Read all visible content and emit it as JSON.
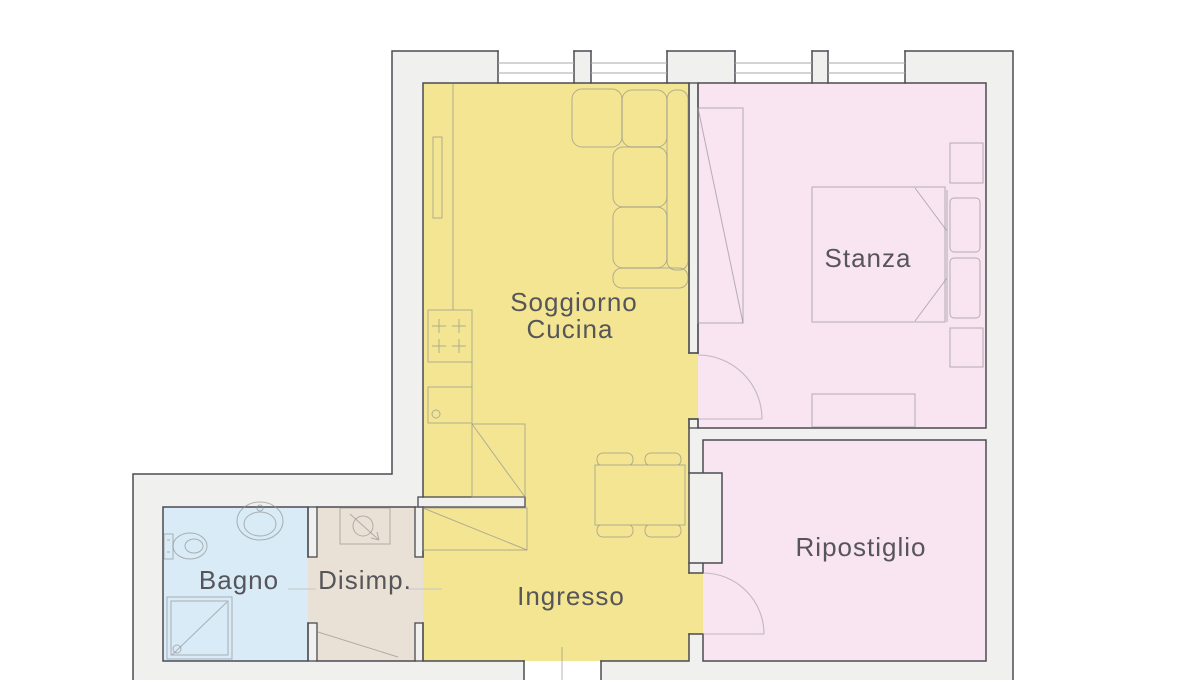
{
  "plan": {
    "title": "Apartment floor plan",
    "rooms": {
      "soggiorno_cucina": {
        "label_line1": "Soggiorno",
        "label_line2": "Cucina",
        "color": "#f3e592"
      },
      "stanza": {
        "label": "Stanza",
        "color": "#f9e4f2"
      },
      "ripostiglio": {
        "label": "Ripostiglio",
        "color": "#f9e4f2"
      },
      "bagno": {
        "label": "Bagno",
        "color": "#d8ebf7"
      },
      "disimpegno": {
        "label": "Disimp.",
        "color": "#e9e1d6"
      },
      "ingresso": {
        "label": "Ingresso",
        "color": "#f3e592"
      }
    },
    "colors": {
      "wall_fill": "#f0f0ee",
      "wall_line": "#4b4b52",
      "furniture_line": "#8f8f8f",
      "window_line": "#a8a8a8",
      "label_text": "#55555a",
      "background": "#ffffff"
    }
  }
}
